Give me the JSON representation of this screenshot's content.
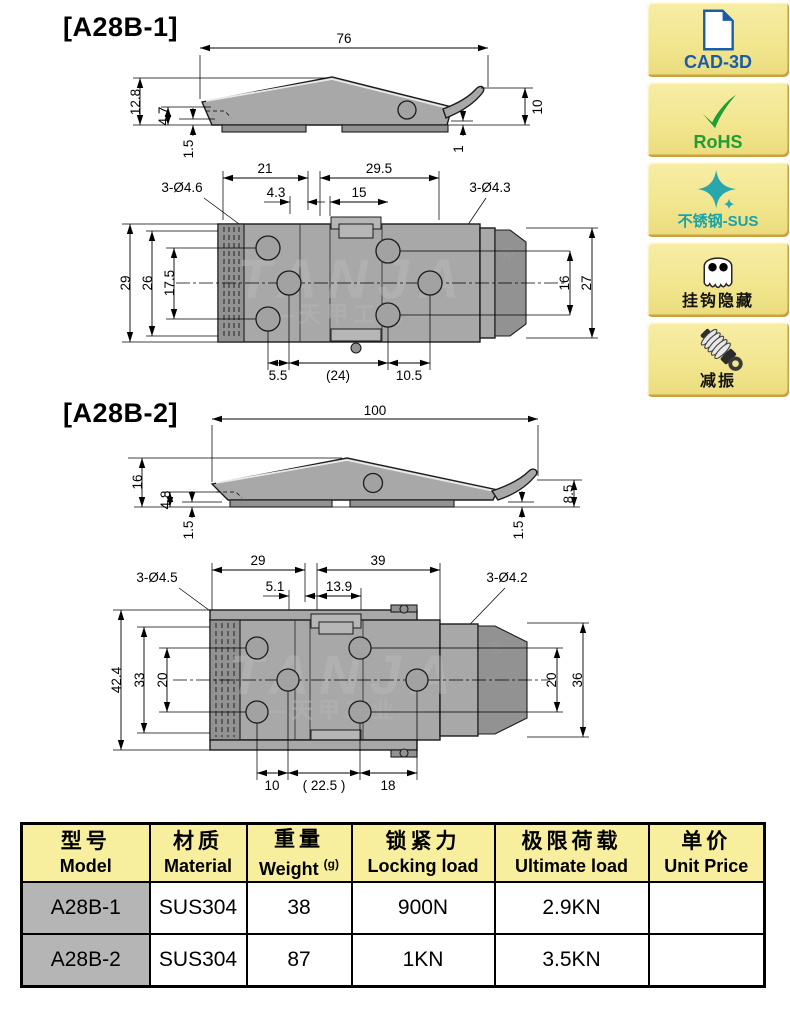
{
  "drawings": {
    "a28b1": {
      "label": "[A28B-1]",
      "side": {
        "length": "76",
        "height": "12.8",
        "nose_height": "4.7",
        "plate_thickness": "1.5",
        "hook_height": "10",
        "tip_gap": "1"
      },
      "top": {
        "holes_left": "3-Ø4.6",
        "holes_right": "3-Ø4.3",
        "span_left": "21",
        "span_right": "29.5",
        "offset_small": "4.3",
        "offset_mid": "15",
        "height_outer": "29",
        "height_inner": "26",
        "hole_pitch_left": "17.5",
        "hole_pitch_right": "16",
        "cap_height": "27",
        "pitch_a": "5.5",
        "pitch_b": "(24)",
        "pitch_c": "10.5"
      }
    },
    "a28b2": {
      "label": "[A28B-2]",
      "side": {
        "length": "100",
        "height": "16",
        "nose_height": "4.8",
        "plate_thickness": "1.5",
        "tip_plate": "1.5",
        "hook_height": "8.5"
      },
      "top": {
        "holes_left": "3-Ø4.5",
        "holes_right": "3-Ø4.2",
        "span_left": "29",
        "span_right": "39",
        "offset_small": "5.1",
        "offset_mid": "13.9",
        "height_outer": "42.4",
        "height_inner": "33",
        "hole_pitch_left": "20",
        "hole_pitch_right": "20",
        "cap_height": "36",
        "pitch_a": "10",
        "pitch_b": "( 22.5 )",
        "pitch_c": "18"
      }
    },
    "watermark": {
      "brand": "TANJA",
      "cn": "—天甲工业—",
      "registered": "®"
    }
  },
  "badges": [
    {
      "label": "CAD-3D",
      "icon": "cad-document-icon",
      "color": "#1B5CA8"
    },
    {
      "label": "RoHS",
      "icon": "checkmark-icon",
      "color": "#1E9E33"
    },
    {
      "label": "不锈钢-SUS",
      "icon": "sparkle-icon",
      "color": "#18A3A8"
    },
    {
      "label": "挂钩隐藏",
      "icon": "ghost-icon",
      "color": "#111111"
    },
    {
      "label": "减振",
      "icon": "shock-absorber-icon",
      "color": "#111111"
    }
  ],
  "table": {
    "headers": [
      {
        "zh": "型号",
        "en": "Model"
      },
      {
        "zh": "材质",
        "en": "Material"
      },
      {
        "zh": "重量",
        "en": "Weight",
        "sup": "(g)"
      },
      {
        "zh": "锁紧力",
        "en": "Locking load"
      },
      {
        "zh": "极限荷载",
        "en": "Ultimate load"
      },
      {
        "zh": "单价",
        "en": "Unit Price"
      }
    ],
    "rows": [
      [
        "A28B-1",
        "SUS304",
        "38",
        "900N",
        "2.9KN",
        ""
      ],
      [
        "A28B-2",
        "SUS304",
        "87",
        "1KN",
        "3.5KN",
        ""
      ]
    ]
  },
  "colors": {
    "badge_bg": "#F2E68F",
    "badge_shadow": "#C9A23E",
    "cad_blue": "#1B5CA8",
    "rohs_green": "#1E9E33",
    "sus_teal": "#18A3A8",
    "table_header_bg": "#F7EF9E",
    "model_cell_bg": "#B5B5B5",
    "part_gray": "#A8A8A8"
  }
}
